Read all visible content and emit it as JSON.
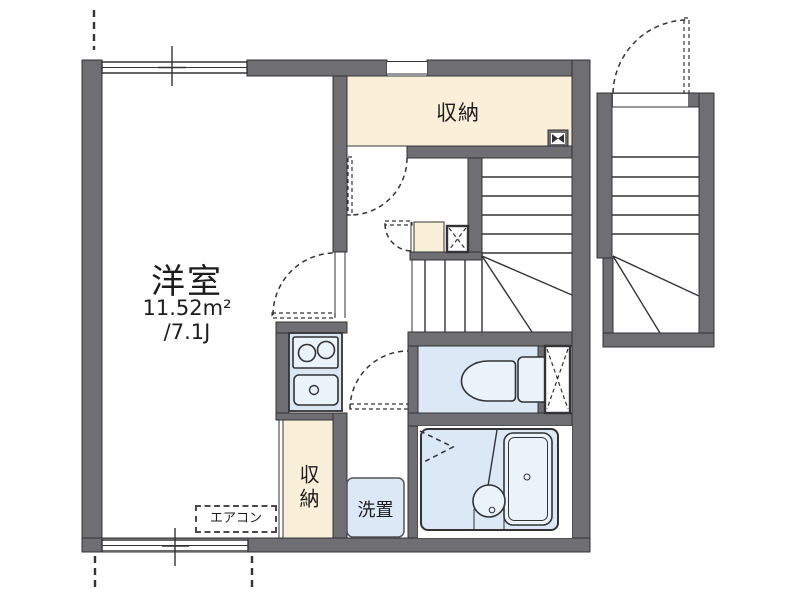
{
  "floor_plan": {
    "main_room": {
      "label": "洋室",
      "area_sqm": "11.52m²",
      "area_tatami": "/7.1J"
    },
    "closet_top": {
      "label": "収納"
    },
    "closet_lower": {
      "label": "収納"
    },
    "laundry_space": {
      "label": "洗置"
    },
    "air_conditioner": {
      "label": "エアコン"
    },
    "colors": {
      "wall": "#6e6e73",
      "line": "#333333",
      "closet": "#faf0da",
      "wet": "#dbe8f5",
      "fixture": "#eaf2fa",
      "bg": "#ffffff"
    }
  }
}
